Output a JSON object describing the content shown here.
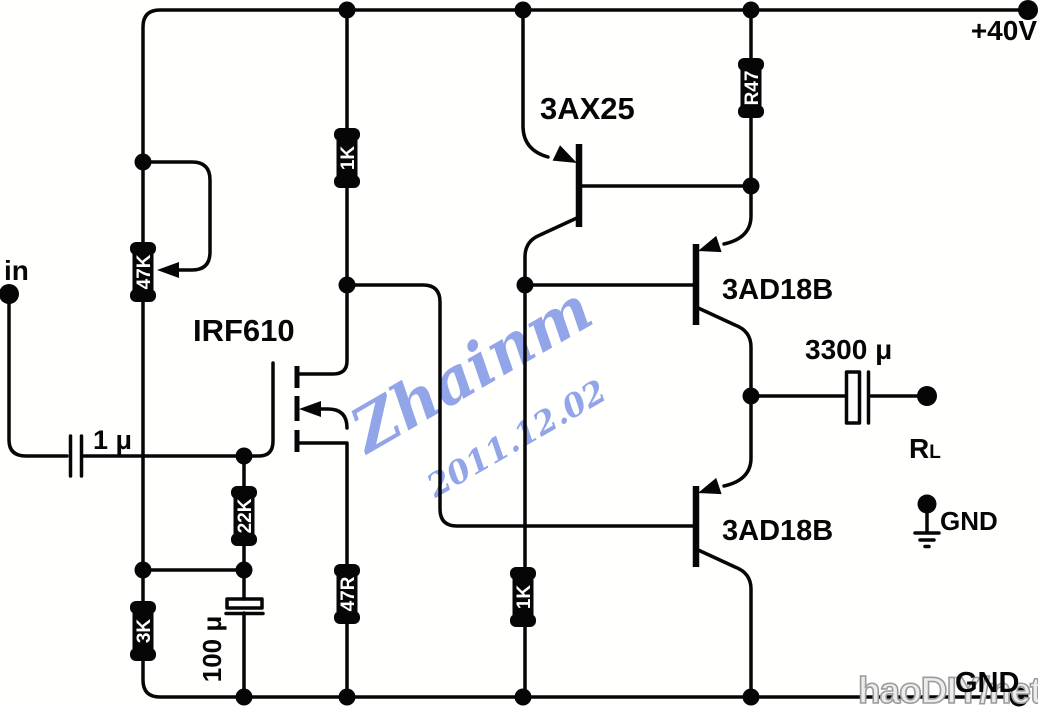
{
  "diagram": {
    "kind": "audio power amplifier schematic",
    "background": "#fffffe",
    "ink": "#060606"
  },
  "power": {
    "supply_label": "+40V",
    "ground_label_mid": "GND",
    "ground_label_bottom": "GND"
  },
  "input": {
    "label": "in"
  },
  "output": {
    "load_label_main": "R",
    "load_label_sub": "L"
  },
  "resistors": {
    "r1": {
      "value": "47K",
      "type": "adjustable"
    },
    "r2": {
      "value": "1K"
    },
    "r3": {
      "value": "R47"
    },
    "r4": {
      "value": "22K"
    },
    "r5": {
      "value": "3K"
    },
    "r6": {
      "value": "47R"
    },
    "r7": {
      "value": "1K"
    }
  },
  "capacitors": {
    "c1": {
      "value": "1 μ"
    },
    "c2": {
      "value": "100 μ"
    },
    "c3": {
      "value": "3300 μ"
    }
  },
  "transistors": {
    "q1": {
      "part": "3AX25"
    },
    "q2": {
      "part": "IRF610"
    },
    "q3": {
      "part": "3AD18B"
    },
    "q4": {
      "part": "3AD18B"
    }
  },
  "watermark": {
    "signature": "Zhainm",
    "date": "2011.12.02",
    "site": "haoDIY/net",
    "blue": "#8399e6",
    "site_fill": "#ececec"
  }
}
